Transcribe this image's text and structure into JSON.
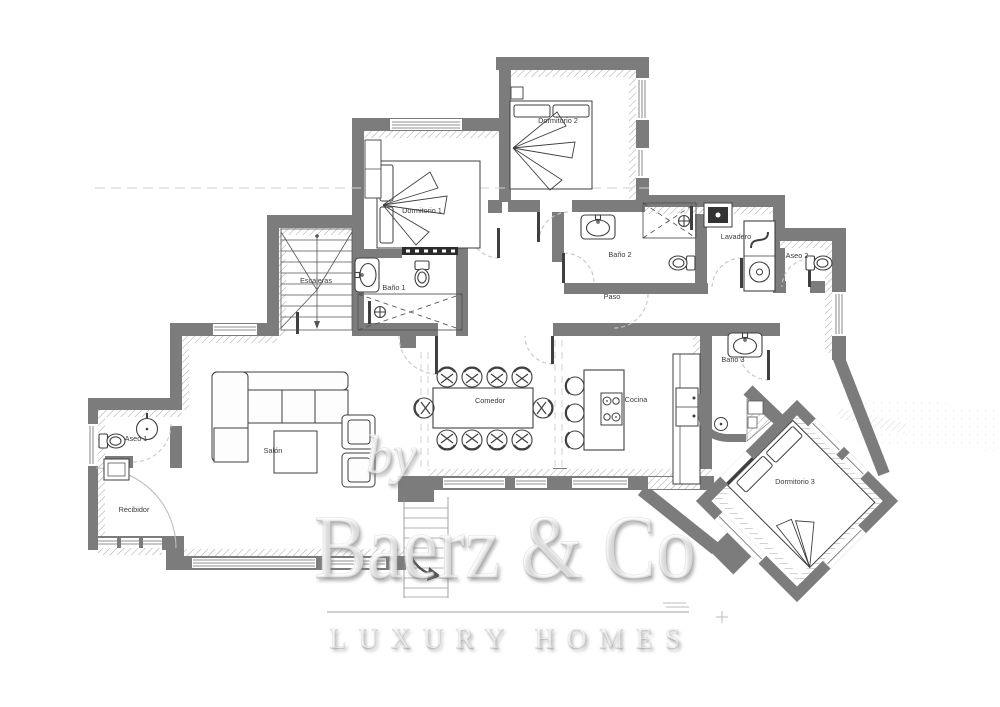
{
  "plan": {
    "rooms": [
      {
        "label": "Dormitorio 1"
      },
      {
        "label": "Dormitorio 2"
      },
      {
        "label": "Dormitorio 3"
      },
      {
        "label": "Baño 1"
      },
      {
        "label": "Baño 2"
      },
      {
        "label": "Baño 3"
      },
      {
        "label": "Aseo 1"
      },
      {
        "label": "Aseo 2"
      },
      {
        "label": "Lavadero"
      },
      {
        "label": "Escaleras"
      },
      {
        "label": "Paso"
      },
      {
        "label": "Salón"
      },
      {
        "label": "Comedor"
      },
      {
        "label": "Cocina"
      },
      {
        "label": "Recibidor"
      }
    ]
  },
  "watermark": {
    "prefix": "by",
    "brand": "Baerz & Co",
    "tagline": "LUXURY HOMES"
  },
  "colors": {
    "wall": "#7c7c7c",
    "furniture_line": "#3f3f3f",
    "hatch": "#adadad",
    "door_arc": "#c6c6c6",
    "label_text": "#3a3a3a",
    "watermark_shadow": "#7a7a7a"
  }
}
